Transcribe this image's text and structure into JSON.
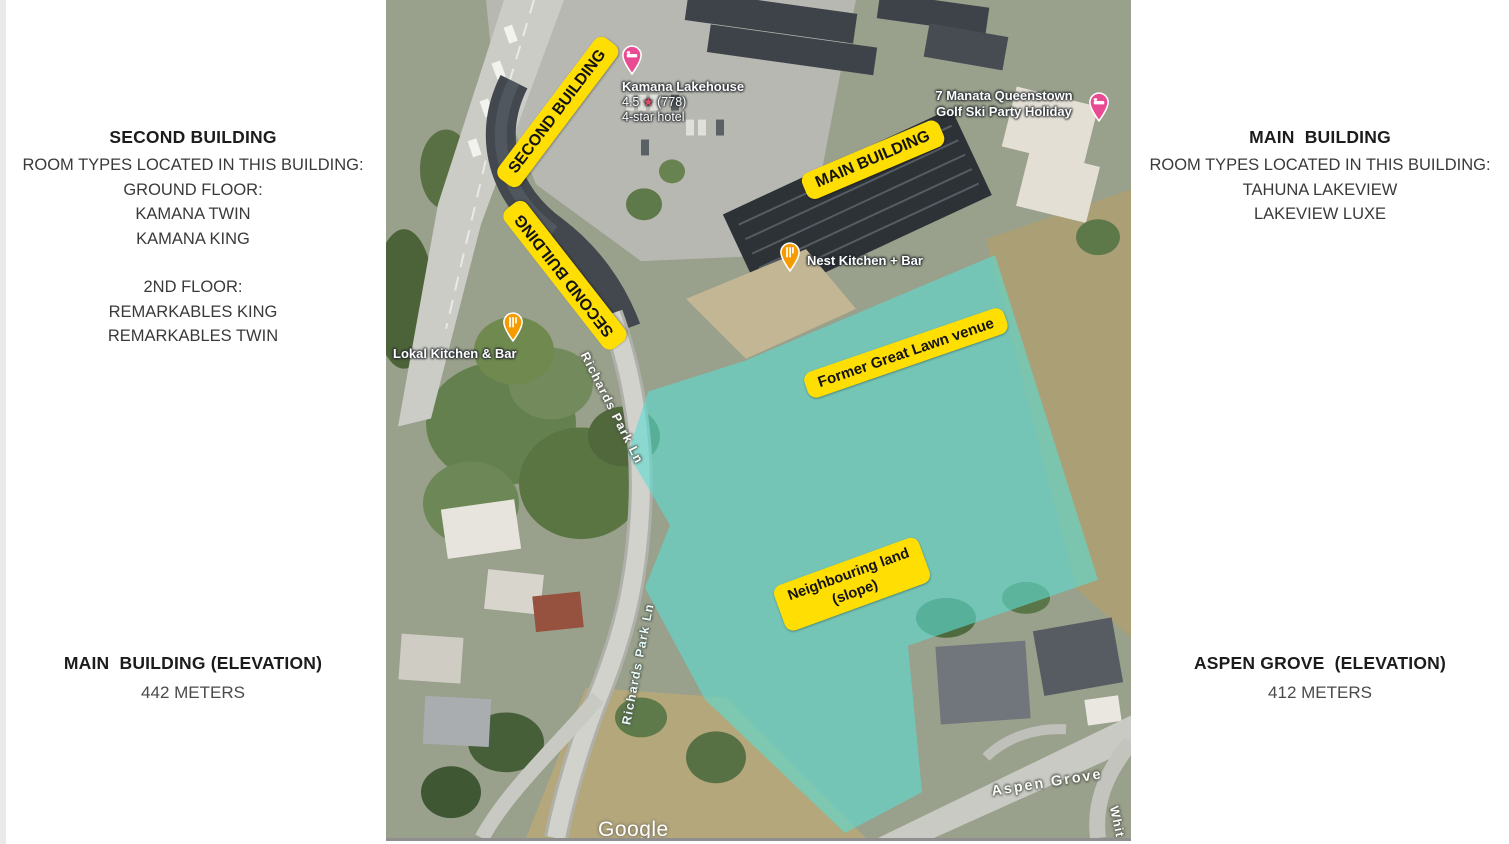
{
  "sidebars": {
    "left_top": {
      "title": "SECOND BUILDING",
      "subtitle": "ROOM TYPES LOCATED IN THIS BUILDING:",
      "ground": {
        "heading": "GROUND FLOOR:",
        "rooms": [
          "KAMANA TWIN",
          "KAMANA KING"
        ]
      },
      "second": {
        "heading": "2ND FLOOR:",
        "rooms": [
          "REMARKABLES KING",
          "REMARKABLES TWIN"
        ]
      }
    },
    "right_top": {
      "title": "MAIN  BUILDING",
      "subtitle": "ROOM TYPES LOCATED IN THIS BUILDING:",
      "rooms": [
        "TAHUNA LAKEVIEW",
        "LAKEVIEW LUXE"
      ]
    },
    "left_bottom": {
      "title": "MAIN  BUILDING (ELEVATION)",
      "value": "442 METERS"
    },
    "right_bottom": {
      "title": "ASPEN GROVE  (ELEVATION)",
      "value": "412 METERS"
    }
  },
  "map": {
    "overlays": {
      "second_building_1": "SECOND BUILDING",
      "second_building_2": "SECOND BUILDING",
      "main_building": "MAIN BUILDING",
      "former_great_lawn": "Former Great Lawn venue",
      "neighbouring_line1": "Neighbouring land",
      "neighbouring_line2": "(slope)",
      "label_bg": "#FFDE04",
      "label_text_color": "#131313",
      "highlight_color": "#5DDBD0"
    },
    "pois": {
      "kamana": {
        "name": "Kamana Lakehouse",
        "rating": "4.5",
        "star": "★",
        "reviews": "(778)",
        "subtitle": "4-star hotel",
        "marker": "lodging",
        "marker_color": "#E94B93",
        "star_color": "#E24A68"
      },
      "manata": {
        "line1": "7 Manata Queenstown",
        "line2": "Golf Ski Party Holiday",
        "marker": "lodging",
        "marker_color": "#E94B93"
      },
      "nest": {
        "name": "Nest Kitchen + Bar",
        "marker": "restaurant",
        "marker_color": "#F59B00"
      },
      "lokal": {
        "name": "Lokal Kitchen & Bar",
        "marker": "restaurant",
        "marker_color": "#F59B00"
      }
    },
    "streets": {
      "richards_1": "Richards Park Ln",
      "richards_2": "Richards Park Ln",
      "aspen": "Aspen Grove",
      "whit": "Whit"
    },
    "watermark": "Google"
  }
}
